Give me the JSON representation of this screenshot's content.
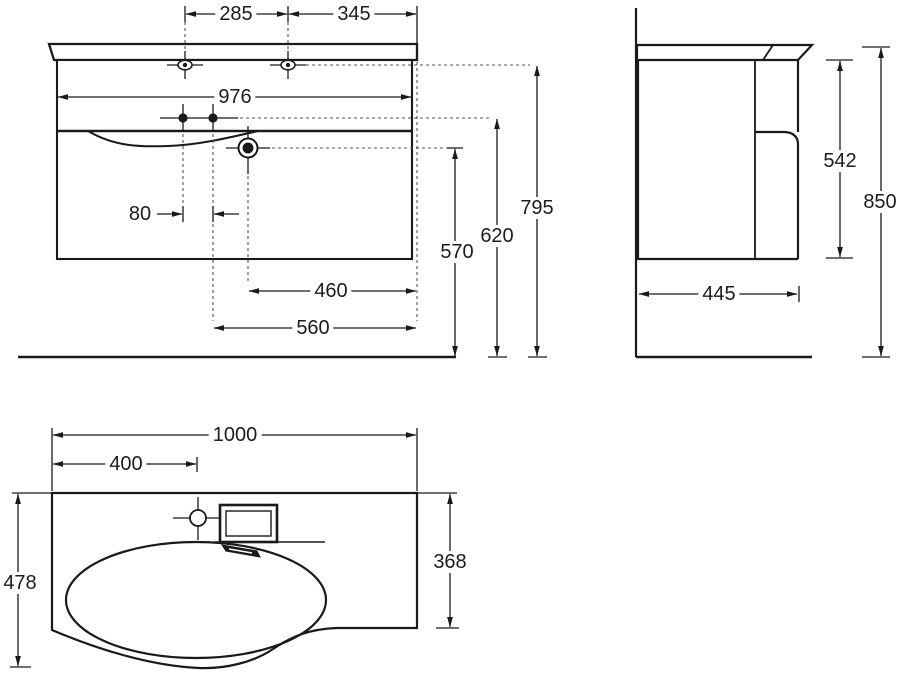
{
  "drawing": {
    "type": "technical-dimension-drawing",
    "subject": "wall-hung vanity unit with basin",
    "colors": {
      "line": "#1a1a1a",
      "background": "#ffffff"
    },
    "views": {
      "front": {
        "dims": {
          "hole_spacing_left": "285",
          "hole_spacing_right": "345",
          "cabinet_width": "976",
          "faucet_hole_spacing": "80",
          "drain_offset": "460",
          "faucet_offset": "560",
          "drain_height": "570",
          "faucet_height": "620",
          "mount_height": "795"
        }
      },
      "side": {
        "dims": {
          "cabinet_height": "542",
          "total_height": "850",
          "depth": "445"
        }
      },
      "plan": {
        "dims": {
          "total_width": "1000",
          "tap_offset": "400",
          "left_depth": "478",
          "right_depth": "368"
        }
      }
    }
  }
}
